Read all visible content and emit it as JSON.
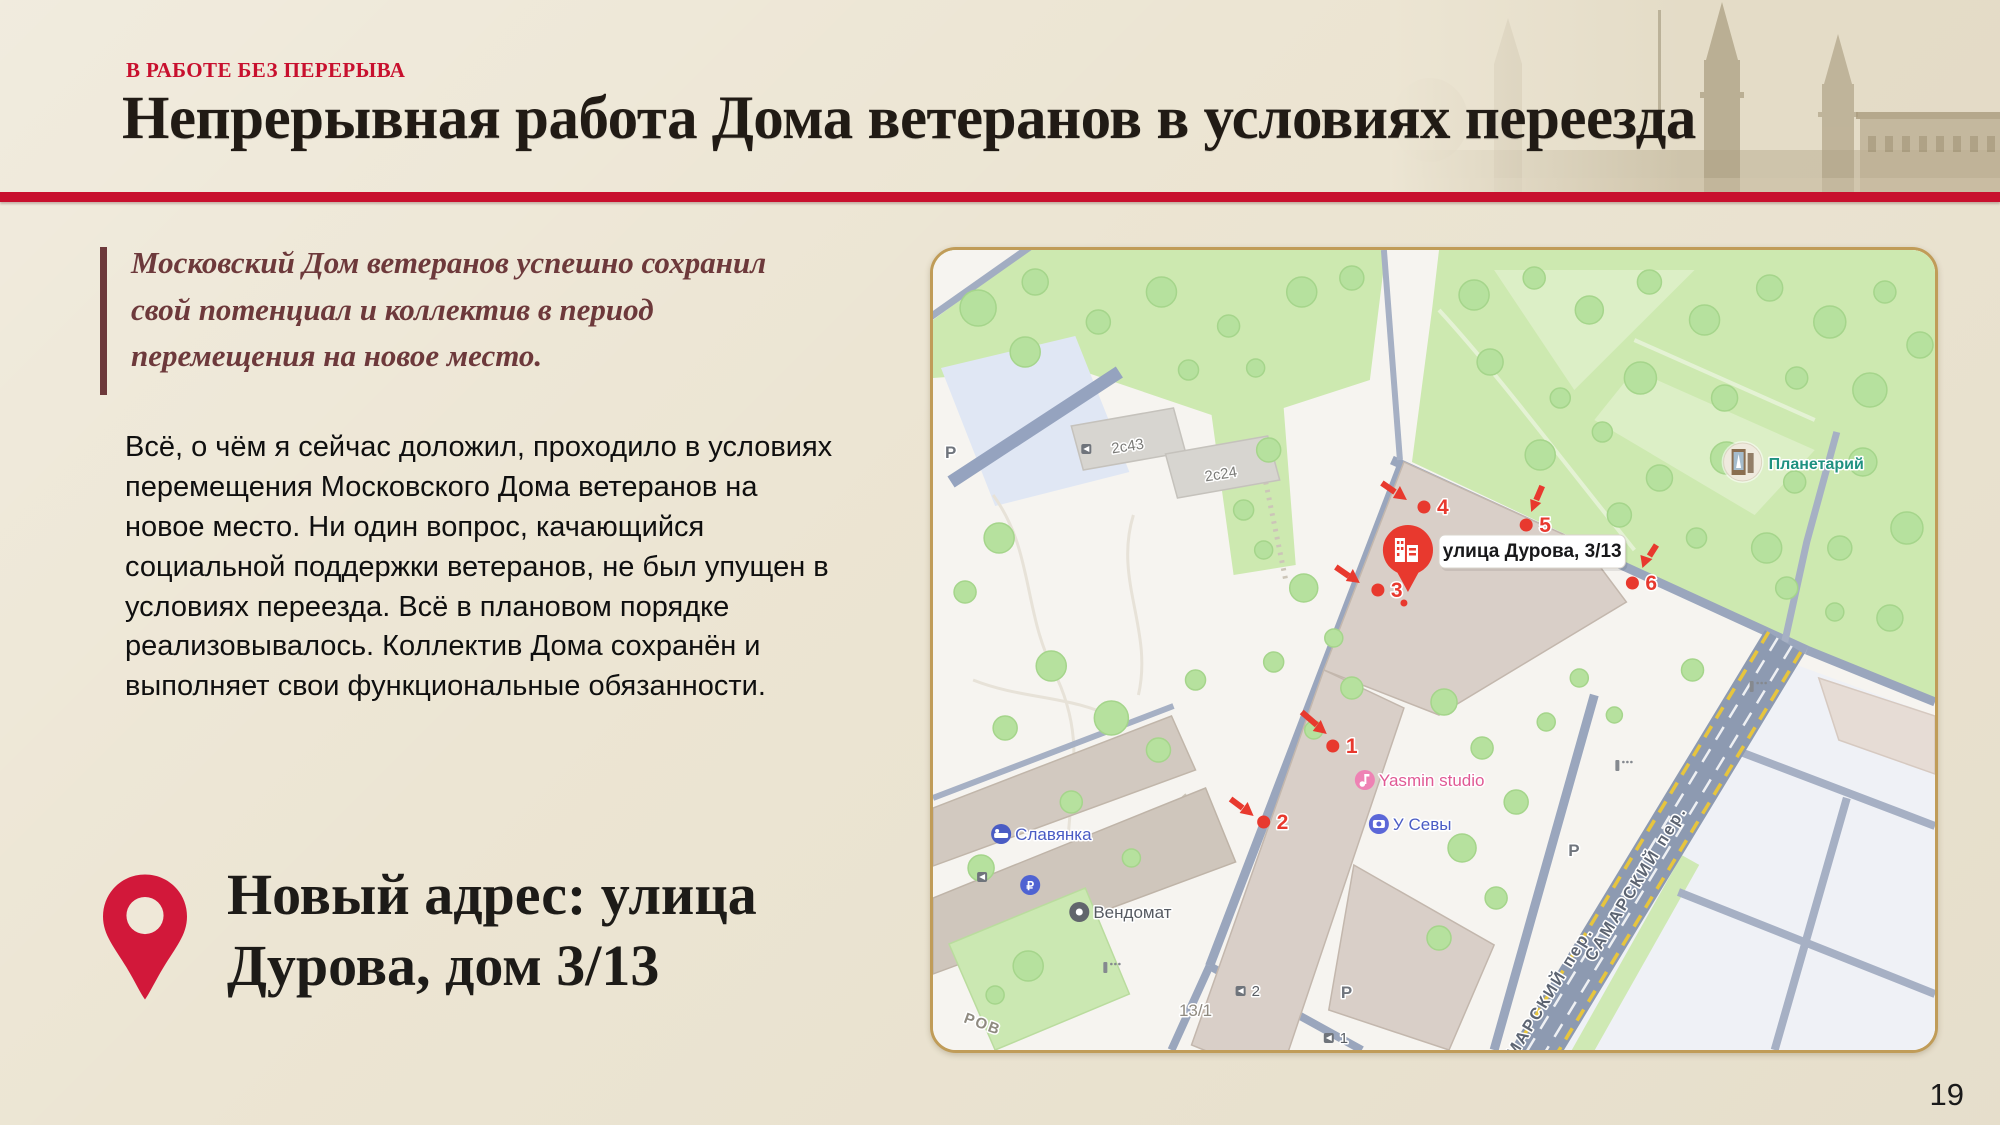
{
  "slide": {
    "kicker": "В РАБОТЕ БЕЗ ПЕРЕРЫВА",
    "title": "Непрерывная работа Дома ветеранов в условиях переезда",
    "page_number": "19",
    "colors": {
      "accent_red": "#c8102e",
      "quote_maroon": "#6d393b",
      "background": "#ece5d3",
      "marker_red": "#e8392e",
      "pin_red": "#d2183a",
      "map_border": "#c09c58"
    }
  },
  "quote": {
    "text": "Московский Дом ветеранов успешно сохранил свой потенциал и коллектив в период перемещения на новое место."
  },
  "body": {
    "text": "Всё, о чём я сейчас доложил, проходило в условиях перемещения Московского Дома ветеранов на новое место. Ни один вопрос, качающийся социальной поддержки ветеранов, не был упущен в условиях переезда. Всё в плановом порядке реализовывалось. Коллектив Дома сохранён и выполняет свои функциональные обязанности."
  },
  "address": {
    "line1": "Новый адрес: улица",
    "line2": "Дурова, дом 3/13"
  },
  "map": {
    "pin_label": "улица Дурова, 3/13",
    "markers": [
      "1",
      "2",
      "3",
      "4",
      "5",
      "6"
    ],
    "building_labels": {
      "b2s43": "2с43",
      "b2s24": "2с24",
      "b13_1": "13/1"
    },
    "street_labels": {
      "samarsky": "САМАРСКИЙ пер.",
      "samarsky_clipped": "МАРСКИЙ пер.",
      "durova_clipped": "РОВ"
    },
    "poi": {
      "hotel": "Славянка",
      "vending": "Вендомат",
      "photo_shop": "У Севы",
      "studio": "Yasmin studio",
      "planetarium": "Планетарий"
    },
    "parking_glyph": "Р",
    "paid_parking_glyph": "₽",
    "entrance_labels": [
      "1",
      "2"
    ],
    "icons": {
      "map_pin": "building-pin-icon",
      "hotel": "bed-icon",
      "vending": "dot-icon",
      "photo_shop": "camera-icon",
      "studio": "music-note-icon",
      "planetarium": "photo-circle-icon",
      "entrance": "door-arrow-icon",
      "lamp": "lamppost-icon",
      "address": "location-pin-icon"
    }
  }
}
